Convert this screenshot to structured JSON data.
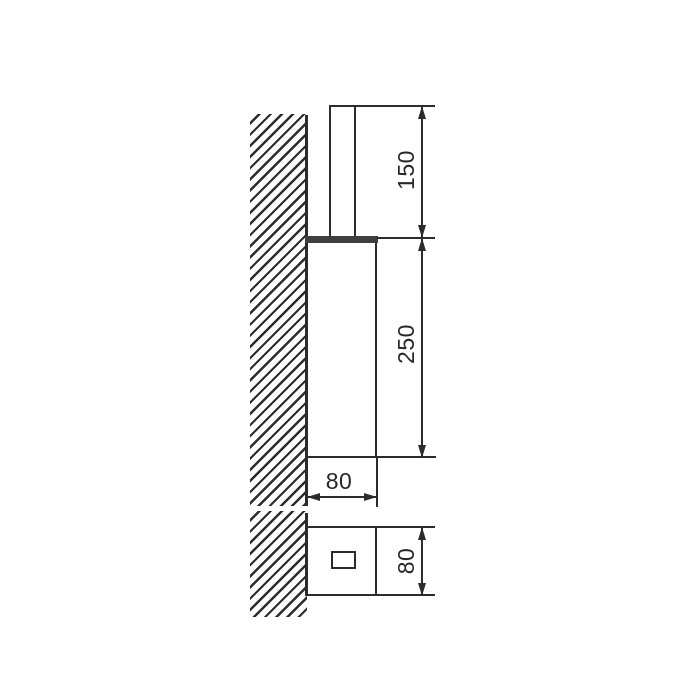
{
  "drawing": {
    "background_color": "#ffffff",
    "line_color": "#2c2c2c",
    "views": {
      "side_view": "side elevation with wall section",
      "top_view": "plan view with wall section"
    },
    "dimensions": {
      "handle_height": "150",
      "body_height": "250",
      "body_width": "80",
      "body_depth": "80"
    }
  }
}
